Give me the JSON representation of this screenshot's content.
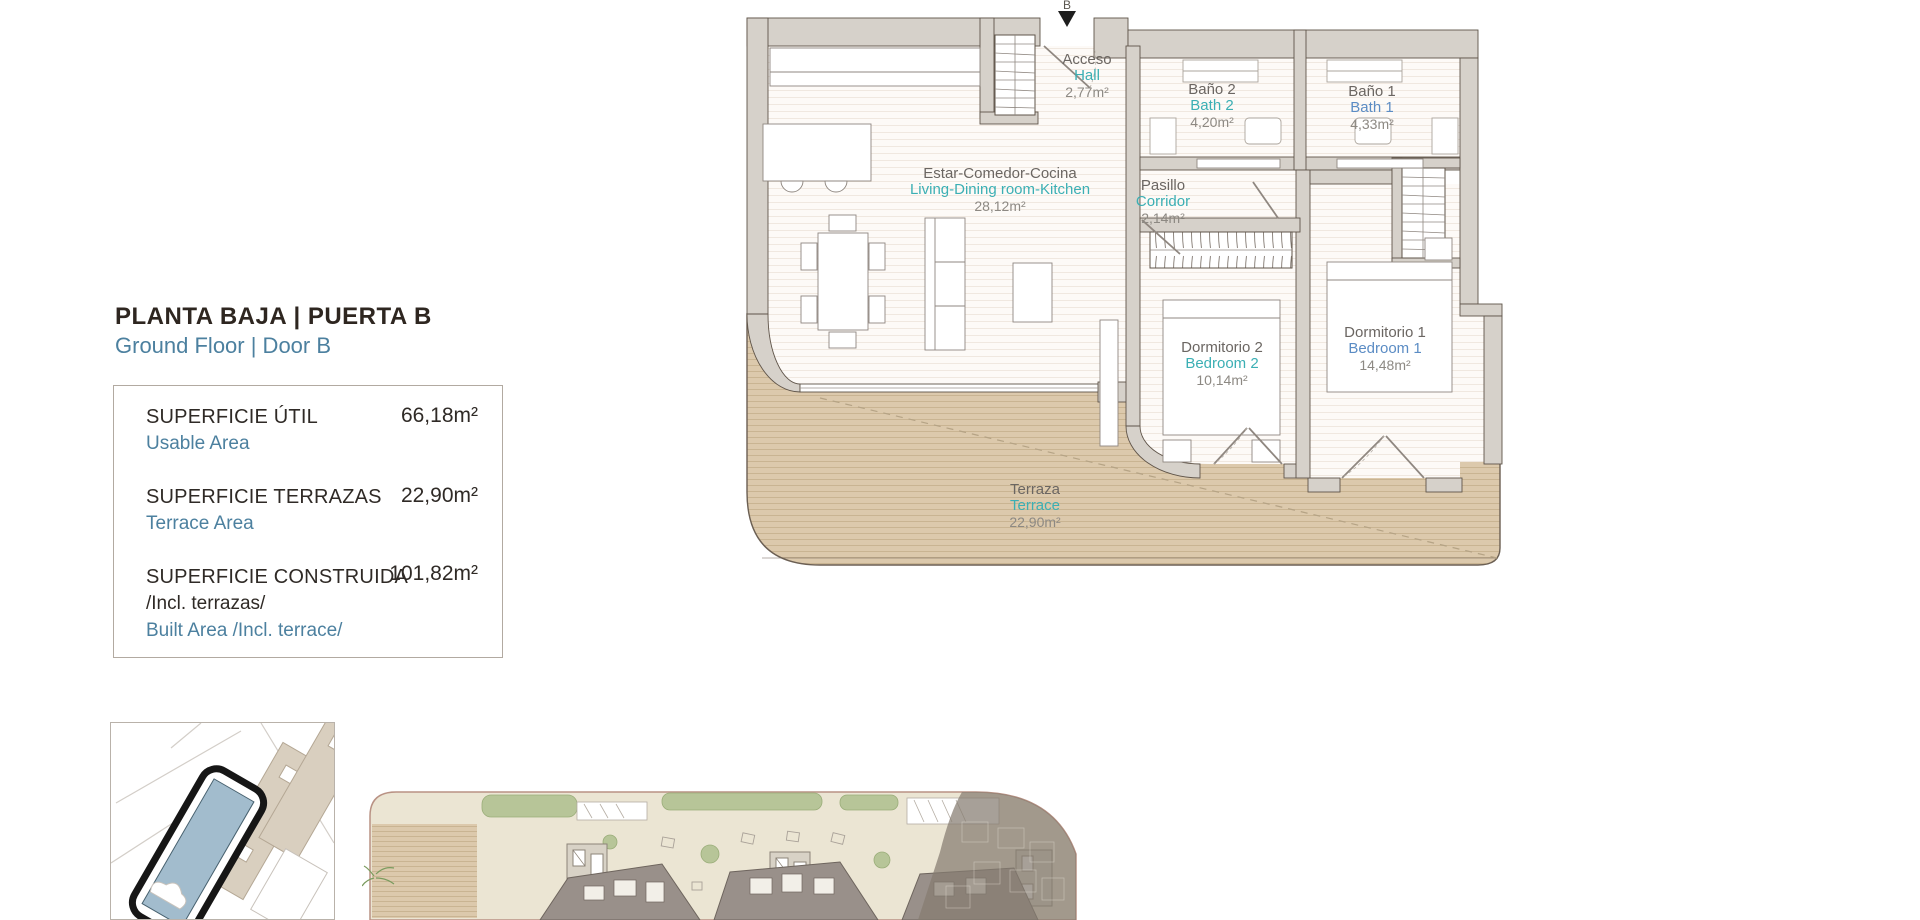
{
  "palette": {
    "title-dark": "#2e2620",
    "blue": "#4c809f",
    "plan-teal": "#3bafb4",
    "plan-blue": "#5b8cc4",
    "label-gray": "#6b6662",
    "area-gray": "#8d8983",
    "wall-fill": "#d6d1ca",
    "wall-line": "#5f5449",
    "terrace-tan": "#dcc9ac",
    "site-building-blue": "#a2bccd"
  },
  "header": {
    "title": "PLANTA BAJA | PUERTA B",
    "subtitle": "Ground Floor | Door B"
  },
  "summary": {
    "rows": [
      {
        "label": "SUPERFICIE ÚTIL",
        "value": "66,18m²",
        "sublabel": "Usable Area"
      },
      {
        "label": "SUPERFICIE TERRAZAS",
        "value": "22,90m²",
        "sublabel": "Terrace Area"
      },
      {
        "label": "SUPERFICIE CONSTRUIDA",
        "value": "101,82m²",
        "sublabel_dark": "/Incl. terrazas/",
        "sublabel": "Built Area /Incl. terrace/"
      }
    ]
  },
  "plan": {
    "entrance_marker": "B",
    "rooms": {
      "hall": {
        "es": "Acceso",
        "en": "Hall",
        "area": "2,77m²"
      },
      "bath2": {
        "es": "Baño 2",
        "en": "Bath 2",
        "area": "4,20m²"
      },
      "bath1": {
        "es": "Baño 1",
        "en": "Bath 1",
        "area": "4,33m²"
      },
      "living": {
        "es": "Estar-Comedor-Cocina",
        "en": "Living-Dining room-Kitchen",
        "area": "28,12m²"
      },
      "corridor": {
        "es": "Pasillo",
        "en": "Corridor",
        "area": "2,14m²"
      },
      "bedroom2": {
        "es": "Dormitorio 2",
        "en": "Bedroom 2",
        "area": "10,14m²"
      },
      "bedroom1": {
        "es": "Dormitorio 1",
        "en": "Bedroom 1",
        "area": "14,48m²"
      },
      "terrace": {
        "es": "Terraza",
        "en": "Terrace",
        "area": "22,90m²"
      }
    }
  }
}
